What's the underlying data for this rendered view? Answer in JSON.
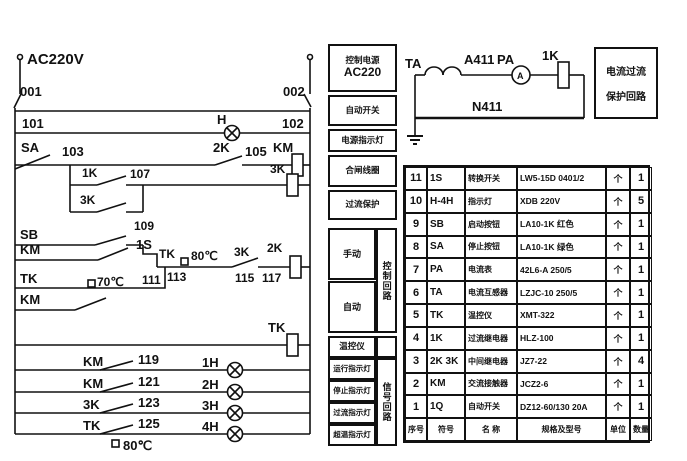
{
  "ladder": {
    "supply_label": "AC220V",
    "wires": {
      "n001": "001",
      "n002": "002",
      "n101": "101",
      "n102": "102",
      "n103": "103",
      "n105": "105",
      "n107": "107",
      "n109": "109",
      "n111": "111",
      "n113": "113",
      "n115": "115",
      "n117": "117"
    },
    "devices": {
      "lamp_h": "H",
      "sa": "SA",
      "sb": "SB",
      "s1": "1S",
      "km_coil": "KM",
      "km_hold": "KM",
      "km_contact2": "KM",
      "k2_contact": "2K",
      "k2_coil": "2K",
      "k1_contact": "1K",
      "k3_coil": "3K",
      "k3_contact": "3K",
      "k3_contact2": "3K",
      "tk80": "TK",
      "tk70": "TK",
      "tk_coil": "TK",
      "temp80": "80℃",
      "temp70": "70℃",
      "temp80_bottom": "80℃"
    },
    "signal_rungs": [
      {
        "contact": "KM",
        "wire": "119",
        "lamp": "1H"
      },
      {
        "contact": "KM",
        "wire": "121",
        "lamp": "2H"
      },
      {
        "contact": "3K",
        "wire": "123",
        "lamp": "3H"
      },
      {
        "contact": "TK",
        "wire": "125",
        "lamp": "4H"
      }
    ]
  },
  "ct_circuit": {
    "ta": "TA",
    "a411": "A411",
    "pa": "PA",
    "ammeter_letter": "A",
    "k1": "1K",
    "n411": "N411",
    "note_line1": "电流过流",
    "note_line2": "保护回路"
  },
  "function_column": {
    "power_title": "控制电源",
    "power_value": "AC220",
    "breaker": "自动开关",
    "power_lamp": "电源指示灯",
    "closing_coil": "合闸线圈",
    "oc_protect": "过流保护",
    "manual": "手动",
    "auto": "自动",
    "temp_ctrl": "温控仪",
    "run_lamp": "运行指示灯",
    "stop_lamp": "停止指示灯",
    "oc_lamp": "过流指示灯",
    "ot_lamp": "超温指示灯",
    "ctrl_loop": "控制回路",
    "signal_loop": "信号回路"
  },
  "table": {
    "header": [
      "序号",
      "符号",
      "名 称",
      "规格及型号",
      "单位",
      "数量"
    ],
    "rows": [
      [
        "11",
        "1S",
        "转换开关",
        "LW5-15D 0401/2",
        "个",
        "1"
      ],
      [
        "10",
        "H-4H",
        "指示灯",
        "XDB 220V",
        "个",
        "5"
      ],
      [
        "9",
        "SB",
        "启动按钮",
        "LA10-1K 红色",
        "个",
        "1"
      ],
      [
        "8",
        "SA",
        "停止按钮",
        "LA10-1K 绿色",
        "个",
        "1"
      ],
      [
        "7",
        "PA",
        "电流表",
        "42L6-A 250/5",
        "个",
        "1"
      ],
      [
        "6",
        "TA",
        "电流互感器",
        "LZJC-10 250/5",
        "个",
        "1"
      ],
      [
        "5",
        "TK",
        "温控仪",
        "XMT-322",
        "个",
        "1"
      ],
      [
        "4",
        "1K",
        "过流继电器",
        "HLZ-100",
        "个",
        "1"
      ],
      [
        "3",
        "2K 3K",
        "中间继电器",
        "JZ7-22",
        "个",
        "4"
      ],
      [
        "2",
        "KM",
        "交流接触器",
        "JCZ2-6",
        "个",
        "1"
      ],
      [
        "1",
        "1Q",
        "自动开关",
        "DZ12-60/130 20A",
        "个",
        "1"
      ]
    ]
  }
}
